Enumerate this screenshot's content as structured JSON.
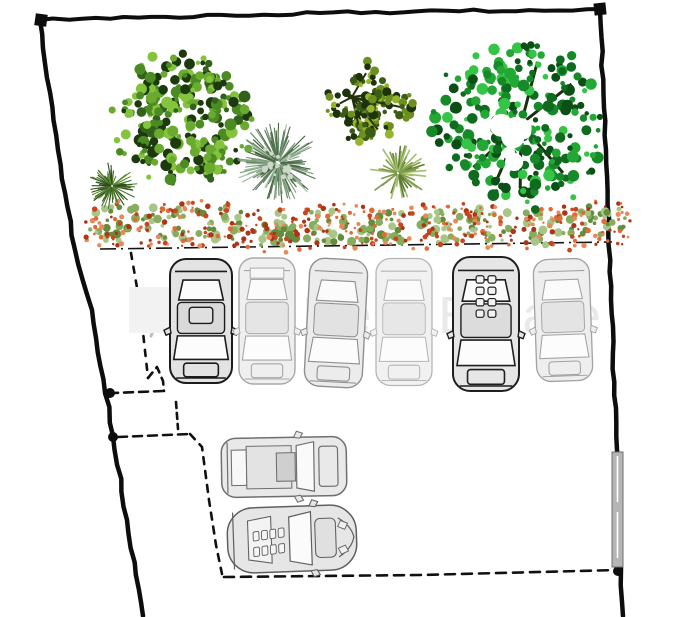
{
  "meta": {
    "width": 691,
    "height": 617,
    "background": "#ffffff",
    "description": "Hand-drawn landscape site plan: plot boundary, trees, flowering hedge row, six parked cars in stalls and two cars in a drive area"
  },
  "watermark": {
    "text": "City Real Estate",
    "text_color": "#e9e9e9",
    "font_size": 52,
    "x": 183,
    "baseline_y": 333,
    "box": {
      "x": 129,
      "y": 287,
      "w": 71,
      "h": 46,
      "color": "#f2f2f2"
    }
  },
  "boundary": {
    "stroke_color": "#0d0d0d",
    "outer_top": [
      [
        40,
        20
      ],
      [
        320,
        13
      ],
      [
        600,
        9
      ]
    ],
    "outer_right": [
      [
        600,
        9
      ],
      [
        606,
        150
      ],
      [
        611,
        300
      ],
      [
        617,
        450
      ],
      [
        621,
        570
      ],
      [
        623,
        616
      ]
    ],
    "outer_left": [
      [
        40,
        20
      ],
      [
        58,
        150
      ],
      [
        75,
        250
      ],
      [
        92,
        310
      ],
      [
        113,
        436
      ],
      [
        127,
        520
      ],
      [
        143,
        616
      ]
    ],
    "corner_squares": [
      {
        "x": 41,
        "y": 20,
        "rot": 8
      },
      {
        "x": 600,
        "y": 9,
        "rot": -6
      }
    ],
    "node_blobs": [
      {
        "x": 110,
        "y": 393
      },
      {
        "x": 113,
        "y": 437
      },
      {
        "x": 618,
        "y": 571
      }
    ],
    "hedge_line": {
      "x1": 100,
      "y1": 249,
      "x2": 612,
      "y2": 242
    },
    "inner_dashed": [
      {
        "name": "stall-divider",
        "points": [
          [
            131,
            253
          ],
          [
            140,
            305
          ],
          [
            148,
            378
          ]
        ],
        "dash": "6 8"
      },
      {
        "name": "divider-hook",
        "points": [
          [
            148,
            378
          ],
          [
            157,
            367
          ],
          [
            163,
            381
          ],
          [
            164,
            391
          ]
        ],
        "dash": "7 6"
      },
      {
        "name": "step-horizontal-1",
        "points": [
          [
            163,
            391
          ],
          [
            114,
            393
          ]
        ],
        "dash": "9 6"
      },
      {
        "name": "step-vertical",
        "points": [
          [
            176,
            402
          ],
          [
            178,
            429
          ]
        ],
        "dash": "6 5"
      },
      {
        "name": "step-horizontal-2",
        "points": [
          [
            118,
            437
          ],
          [
            190,
            434
          ]
        ],
        "dash": "9 6"
      },
      {
        "name": "drive-edge",
        "points": [
          [
            190,
            434
          ],
          [
            202,
            447
          ],
          [
            209,
            500
          ],
          [
            216,
            545
          ],
          [
            222,
            574
          ]
        ],
        "dash": "7 7"
      },
      {
        "name": "bottom-edge",
        "points": [
          [
            224,
            577
          ],
          [
            420,
            575
          ],
          [
            618,
            570
          ]
        ],
        "dash": "10 7"
      }
    ],
    "pen_squiggle": {
      "d": "M150 306 q -10 10 -2 16 q 8 4 3 14",
      "color": "#bdbdbd"
    }
  },
  "gate": {
    "x": 612,
    "y": 452,
    "w": 11,
    "h": 115,
    "fill": "#b5b5b5",
    "stroke": "#6e6e6e"
  },
  "plants": [
    {
      "type": "grass-tuft",
      "name": "dark-grass-tuft",
      "cx": 112,
      "cy": 186,
      "r": 24,
      "palette": [
        "#2f4d1c",
        "#47702a",
        "#5d8c34"
      ]
    },
    {
      "type": "round-bush",
      "name": "large-dark-bush",
      "cx": 182,
      "cy": 118,
      "r": 71,
      "palette": [
        "#1d3a0e",
        "#31611a",
        "#4c8a24",
        "#6aab2f",
        "#83c43c"
      ]
    },
    {
      "type": "fountain-grass",
      "name": "fountain-grass",
      "cx": 278,
      "cy": 163,
      "r": 40,
      "palette": [
        "#5d7d5d",
        "#7d9d7d",
        "#9db89d",
        "#46663f"
      ]
    },
    {
      "type": "open-bush",
      "name": "open-dark-bush",
      "cx": 352,
      "cy": 97,
      "r": 56,
      "palette": [
        "#1e330c",
        "#3c5c14",
        "#6d8f1f",
        "#97b52c"
      ]
    },
    {
      "type": "yucca",
      "name": "yucca-palm",
      "cx": 398,
      "cy": 173,
      "r": 28,
      "palette": [
        "#7e9c4c",
        "#a3bd6b",
        "#5d7c34"
      ]
    },
    {
      "type": "large-tree",
      "name": "large-green-tree",
      "cx": 521,
      "cy": 124,
      "r": 92,
      "palette": [
        "#0f6b1e",
        "#168a28",
        "#23a835",
        "#35c446",
        "#0b4f16"
      ]
    }
  ],
  "hedge": {
    "name": "flowering-hedge-row",
    "y": 227,
    "x_start": 113,
    "x_end": 600,
    "clumps": 10,
    "leaf_palette": [
      "#86ad5c",
      "#a7c687",
      "#648c3c"
    ],
    "flower_palette": [
      "#c9441f",
      "#e06b35",
      "#aa3517",
      "#e8895c"
    ]
  },
  "cars": {
    "stall_row": [
      {
        "variant": "suv-dark",
        "cx": 201,
        "cy": 321,
        "w": 62,
        "h": 124,
        "rot": 0,
        "stroke": "#1c1c1c",
        "fill": "#e3e3e3",
        "stroke_width": 2
      },
      {
        "variant": "wagon-light",
        "cx": 267,
        "cy": 321,
        "w": 56,
        "h": 126,
        "rot": 0,
        "stroke": "#a8a8a8",
        "fill": "#efefef",
        "stroke_width": 1.4
      },
      {
        "variant": "sedan",
        "cx": 336,
        "cy": 323,
        "w": 58,
        "h": 128,
        "rot": 3,
        "stroke": "#8f8f8f",
        "fill": "#ececec",
        "stroke_width": 1.4
      },
      {
        "variant": "sedan-light",
        "cx": 404,
        "cy": 322,
        "w": 56,
        "h": 127,
        "rot": 0,
        "stroke": "#b5b5b5",
        "fill": "#f1f1f1",
        "stroke_width": 1.3
      },
      {
        "variant": "suv-sunroof",
        "cx": 486,
        "cy": 324,
        "w": 66,
        "h": 134,
        "rot": 0,
        "stroke": "#1f1f1f",
        "fill": "#e6e6e6",
        "stroke_width": 2
      },
      {
        "variant": "sedan-light",
        "cx": 563,
        "cy": 320,
        "w": 56,
        "h": 122,
        "rot": -2,
        "stroke": "#a2a2a2",
        "fill": "#eeeeee",
        "stroke_width": 1.3
      }
    ],
    "bottom_row": [
      {
        "variant": "wagon-side",
        "cx": 284,
        "cy": 467,
        "w": 125,
        "h": 59,
        "rot": -1,
        "stroke": "#6f6f6f",
        "fill": "#e9e9e9",
        "stroke_width": 1.5
      },
      {
        "variant": "sports-side",
        "cx": 292,
        "cy": 539,
        "w": 129,
        "h": 65,
        "rot": -2,
        "stroke": "#5f5f5f",
        "fill": "#e6e6e6",
        "stroke_width": 1.5
      }
    ]
  }
}
